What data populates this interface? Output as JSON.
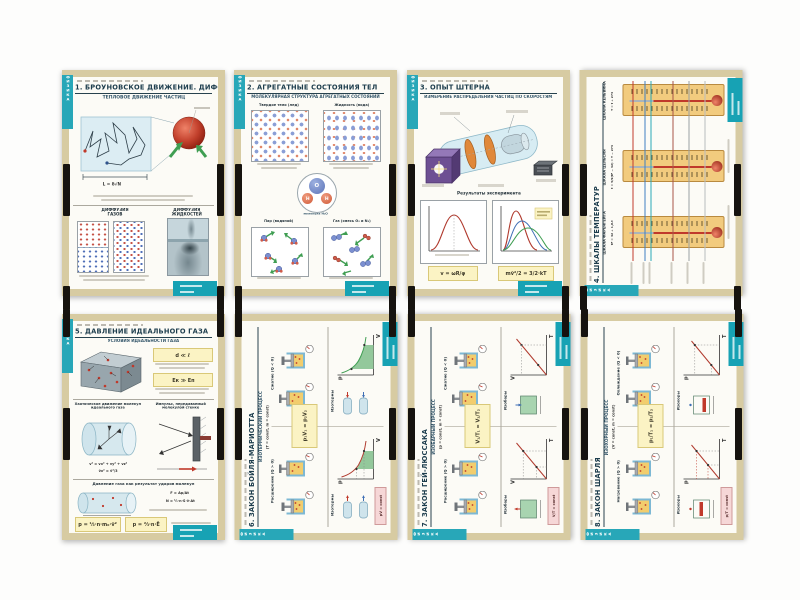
{
  "series": {
    "tab_label": "ФИЗИКА"
  },
  "posters": [
    {
      "title": "1. БРОУНОВСКОЕ ДВИЖЕНИЕ. ДИФФУЗИЯ",
      "subtitle": "ТЕПЛОВОЕ ДВИЖЕНИЕ ЧАСТИЦ",
      "walk_formula": "L = δ√N",
      "gas_label": "ДИФФУЗИЯ\nГАЗОВ",
      "liquid_label": "ДИФФУЗИЯ\nЖИДКОСТЕЙ"
    },
    {
      "title": "2. АГРЕГАТНЫЕ СОСТОЯНИЯ ТЕЛ",
      "subtitle": "МОЛЕКУЛЯРНАЯ СТРУКТУРА АГРЕГАТНЫХ СОСТОЯНИЙ",
      "solid_label": "Твердое тело (лед)",
      "liquid_label": "Жидкость (вода)",
      "vapor_label": "Пар (водяной)",
      "gas_label": "Газ (смесь O₂ и N₂)",
      "atom_o": "O",
      "atom_h1": "H",
      "atom_h2": "H",
      "molecule_caption": "молекула H₂O"
    },
    {
      "title": "3. ОПЫТ ШТЕРНА",
      "subtitle": "ИЗМЕРЕНИЕ РАСПРЕДЕЛЕНИЯ ЧАСТИЦ ПО СКОРОСТЯМ",
      "results_label": "Результаты эксперимента",
      "formula_left": "v = ωR/φ",
      "formula_right": "mv̄²/2 = 3/2·kT"
    },
    {
      "title": "4. ШКАЛЫ ТЕМПЕРАТУР",
      "scales": [
        {
          "name": "ШКАЛА ФАРЕНГЕЙТА",
          "formula": "tF = 32 + 1,8·t"
        },
        {
          "name": "ШКАЛА ЦЕЛЬСИЯ",
          "formula": "t = 5/9(tF − 32) = T − 273"
        },
        {
          "name": "ШКАЛА КЕЛЬВИНА",
          "formula": "T = t + 273"
        }
      ]
    },
    {
      "title": "5. ДАВЛЕНИЕ ИДЕАЛЬНОГО ГАЗА",
      "subtitle": "УСЛОВИЯ ИДЕАЛЬНОСТИ ГАЗА",
      "cond1": "d ≪ ℓ",
      "cond2": "Eк ≫ Eп",
      "chaos_label": "Хаотическое движение молекул\nидеального газа",
      "impulse_label": "Импульс, передаваемый\nмолекулой стенке",
      "formula_v": "v² = vx² + vy² + vz²",
      "formula_v3": "v̄x² = v̄²/3",
      "bottom_label": "Давление газа как результат ударов молекул",
      "formula_f": "F = Δp/Δt",
      "formula_n": "N = ½·n·S·v̄·Δt",
      "formula_p1": "p = ⅓·n·m₀·v̄²",
      "formula_p2": "p = ⅔·n·Ē"
    },
    {
      "title": "6. ЗАКОН БОЙЛЯ-МАРИОТТА",
      "process": "ИЗОТЕРМИЧЕСКИЙ ПРОЦЕСС",
      "process_sub": "(T = const,  m = const)",
      "left_label": "Расширение (Q > 0)",
      "right_label": "Сжатие (Q < 0)",
      "formula": "p₁V₁ = p₂V₂",
      "graph_label": "Изотермы",
      "chip": "pV = const",
      "axis_y": "p",
      "axis_x": "V"
    },
    {
      "title": "7. ЗАКОН ГЕЙ-ЛЮССАКА",
      "process": "ИЗОБАРНЫЙ ПРОЦЕСС",
      "process_sub": "(p = const,  m = const)",
      "left_label": "Расширение (Q > 0)",
      "right_label": "Сжатие (Q < 0)",
      "formula": "V₁/T₁ = V₂/T₂",
      "graph_label": "Изобары",
      "chip": "V/T = const",
      "axis_y": "V",
      "axis_x": "T"
    },
    {
      "title": "8. ЗАКОН ШАРЛЯ",
      "process": "ИЗОХОРНЫЙ ПРОЦЕСС",
      "process_sub": "(V = const,  m = const)",
      "left_label": "Нагревание (Q > 0)",
      "right_label": "Охлаждение (Q < 0)",
      "formula": "p₁/T₁ = p₂/T₂",
      "graph_label": "Изохоры",
      "chip": "p/T = const",
      "axis_y": "p",
      "axis_x": "T"
    }
  ]
}
